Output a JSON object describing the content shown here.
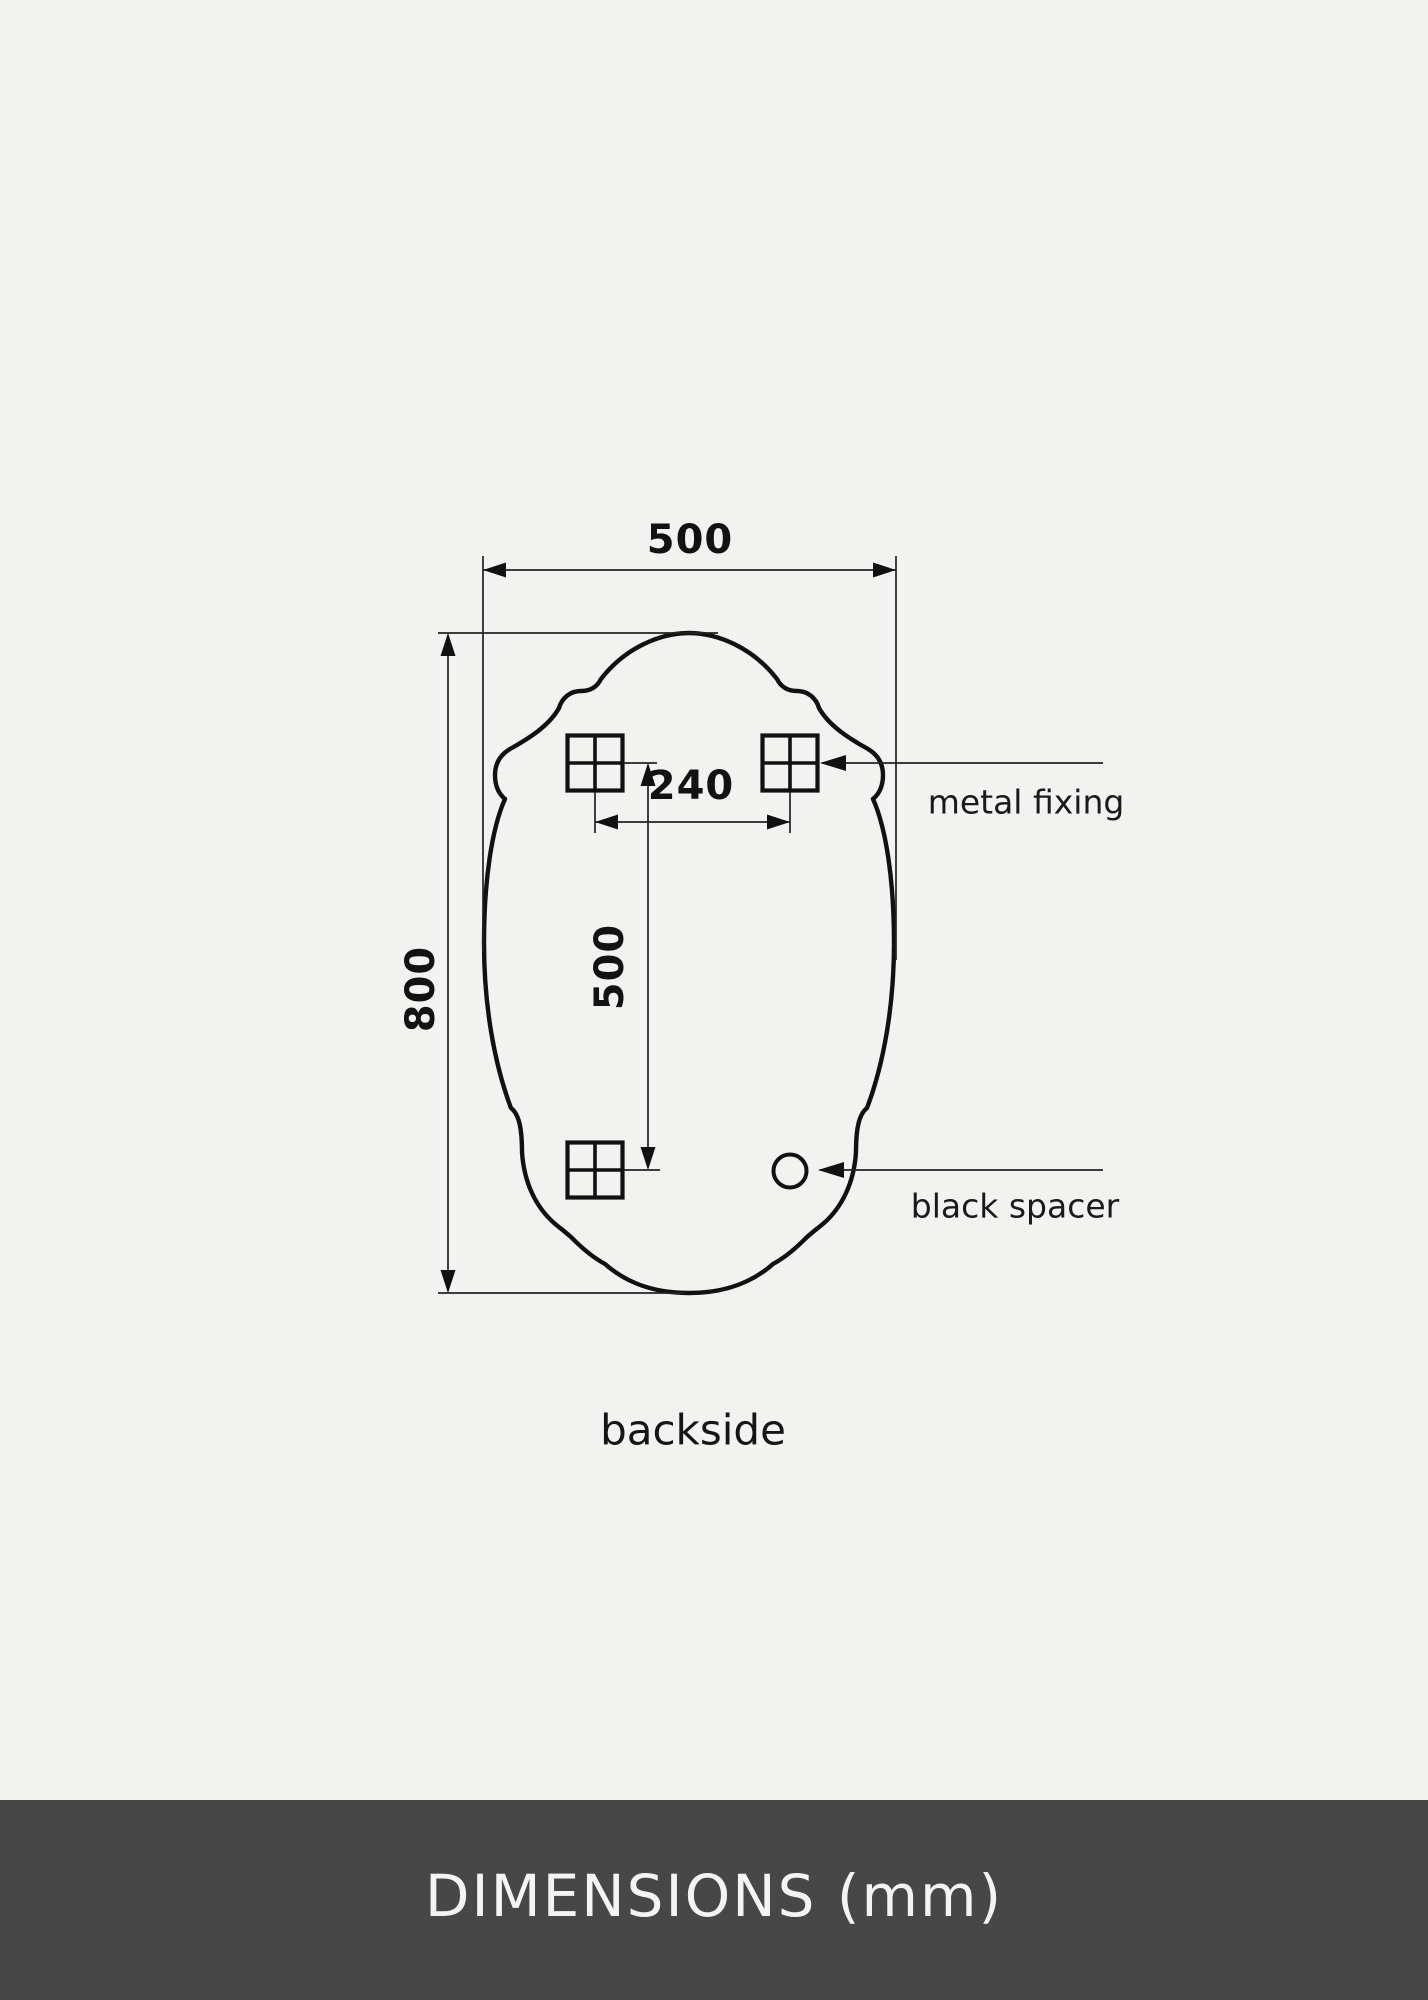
{
  "page": {
    "background_color": "#f2f2f1",
    "ink_color": "#111111",
    "footer": {
      "label": "DIMENSIONS (mm)",
      "bar_color": "#474747",
      "text_color": "#f4f4f3"
    }
  },
  "drawing": {
    "caption": "backside",
    "dimensions": {
      "overall_width_mm": "500",
      "overall_height_mm": "800",
      "fixing_horizontal_spacing_mm": "240",
      "fixing_vertical_spacing_mm": "500"
    },
    "callouts": {
      "metal_fixing": "metal fixing",
      "black_spacer": "black spacer"
    },
    "parts": {
      "fixing_count": "3",
      "spacer_count": "1"
    }
  }
}
